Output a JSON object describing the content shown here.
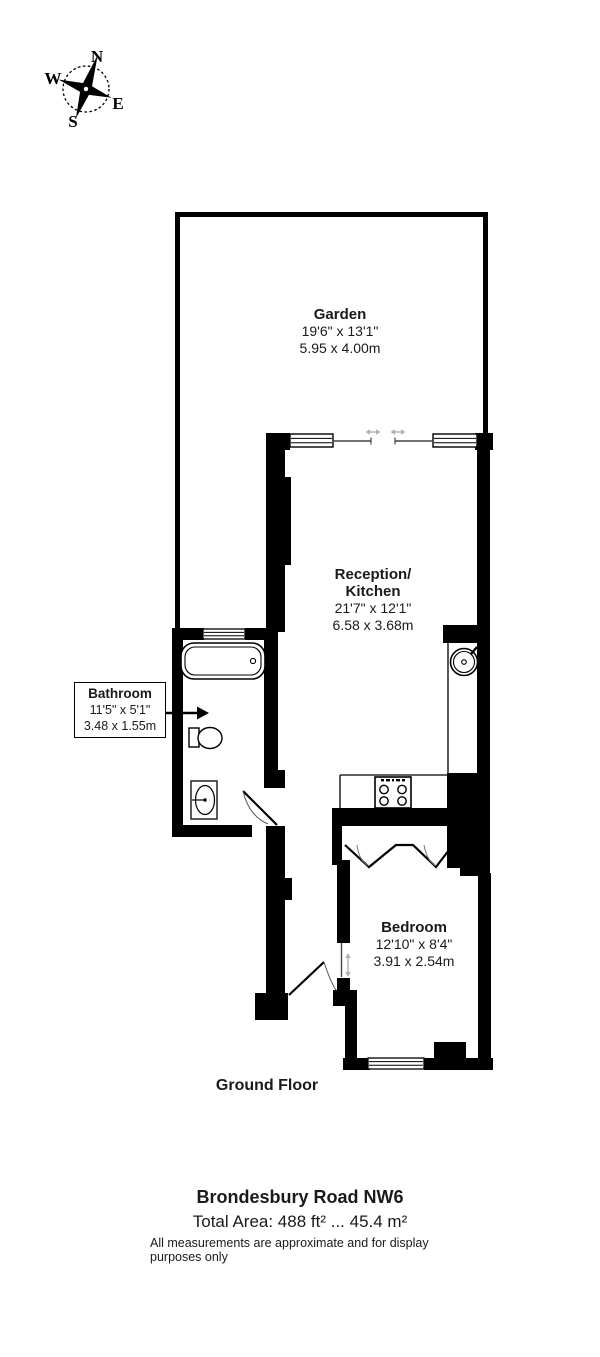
{
  "compass": {
    "north": "N",
    "south": "S",
    "east": "E",
    "west": "W"
  },
  "rooms": {
    "garden": {
      "name": "Garden",
      "imperial": "19'6\" x 13'1\"",
      "metric": "5.95 x 4.00m"
    },
    "reception": {
      "name_line1": "Reception/",
      "name_line2": "Kitchen",
      "imperial": "21'7\" x 12'1\"",
      "metric": "6.58 x 3.68m"
    },
    "bathroom": {
      "name": "Bathroom",
      "imperial": "11'5\" x 5'1\"",
      "metric": "3.48 x 1.55m"
    },
    "bedroom": {
      "name": "Bedroom",
      "imperial": "12'10\" x 8'4\"",
      "metric": "3.91 x 2.54m"
    }
  },
  "floor_label": "Ground Floor",
  "footer": {
    "address": "Brondesbury Road NW6",
    "total_area": "Total Area: 488 ft² ... 45.4 m²",
    "disclaimer": "All measurements are approximate and for display purposes only"
  },
  "colors": {
    "wall": "#000000",
    "background": "#ffffff",
    "arrow_gray": "#b0b0b0"
  }
}
